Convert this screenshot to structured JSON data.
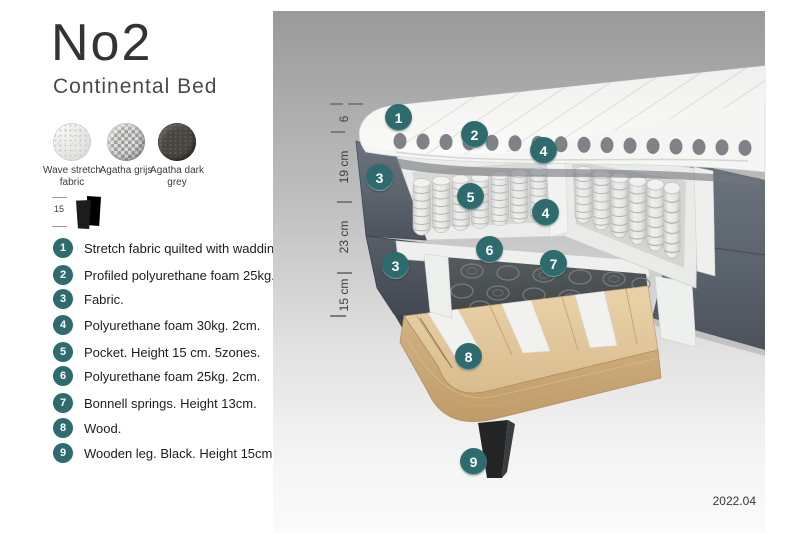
{
  "header": {
    "title": "No2",
    "subtitle": "Continental Bed"
  },
  "swatches": {
    "items": [
      {
        "name": "wave-stretch-fabric",
        "label": "Wave stretch fabric"
      },
      {
        "name": "agatha-grijs",
        "label": "Agatha grijs"
      },
      {
        "name": "agatha-dark-grey",
        "label": "Agatha dark grey"
      }
    ]
  },
  "leg_icon": {
    "height_label": "15"
  },
  "legend": {
    "items": [
      {
        "num": "1",
        "text": "Stretch fabric quilted with wadding."
      },
      {
        "num": "2",
        "text": "Profiled polyurethane foam 25kg. 4cm."
      },
      {
        "num": "3",
        "text": "Fabric."
      },
      {
        "num": "4",
        "text": "Polyurethane foam 30kg. 2cm."
      },
      {
        "num": "5",
        "text": "Pocket. Height 15 cm. 5zones."
      },
      {
        "num": "6",
        "text": "Polyurethane foam 25kg. 2cm."
      },
      {
        "num": "7",
        "text": "Bonnell springs. Height 13cm."
      },
      {
        "num": "8",
        "text": "Wood."
      },
      {
        "num": "9",
        "text": "Wooden leg. Black. Height 15cm."
      }
    ]
  },
  "diagram": {
    "dimensions": [
      {
        "label": "6"
      },
      {
        "label": "19 cm"
      },
      {
        "label": "23 cm"
      },
      {
        "label": "15 cm"
      }
    ],
    "callouts": [
      {
        "n": "1"
      },
      {
        "n": "2"
      },
      {
        "n": "4"
      },
      {
        "n": "3"
      },
      {
        "n": "5"
      },
      {
        "n": "4"
      },
      {
        "n": "6"
      },
      {
        "n": "7"
      },
      {
        "n": "3"
      },
      {
        "n": "8"
      },
      {
        "n": "9"
      }
    ],
    "version": "2022.04"
  },
  "colors": {
    "accent_teal": "#2e6b6e",
    "fabric_slate": "#5d6570",
    "wood": "#e2c89c",
    "background_grey": "#9a9a9a"
  }
}
